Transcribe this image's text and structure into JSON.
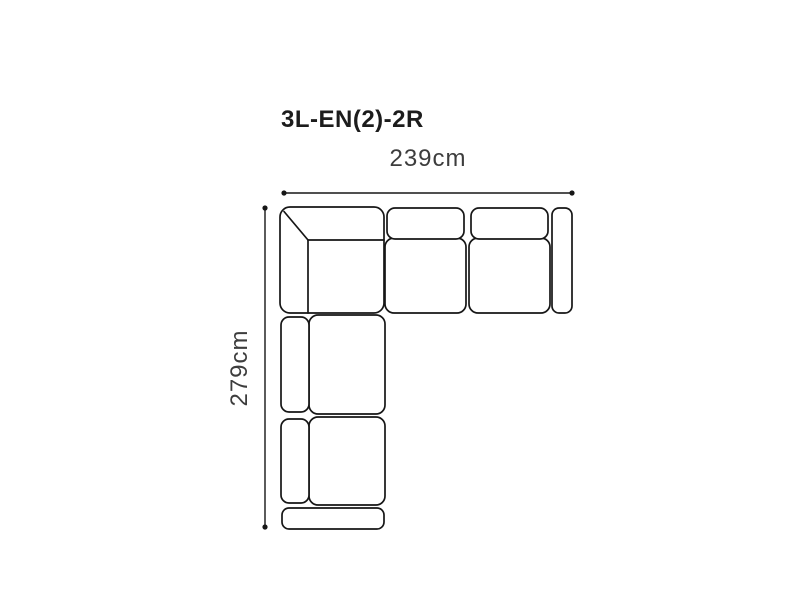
{
  "diagram": {
    "title": "3L-EN(2)-2R",
    "width_label": "239cm",
    "height_label": "279cm",
    "colors": {
      "title": "#1c1c1c",
      "label": "#3d3d3d",
      "line": "#161616",
      "fill": "#ffffff"
    },
    "sofa": {
      "type": "corner-sectional-top-view",
      "sections": [
        "corner-section",
        "top-seat-1",
        "top-seat-2",
        "right-arm",
        "left-seat-1",
        "left-seat-2",
        "bottom-arm"
      ]
    }
  }
}
